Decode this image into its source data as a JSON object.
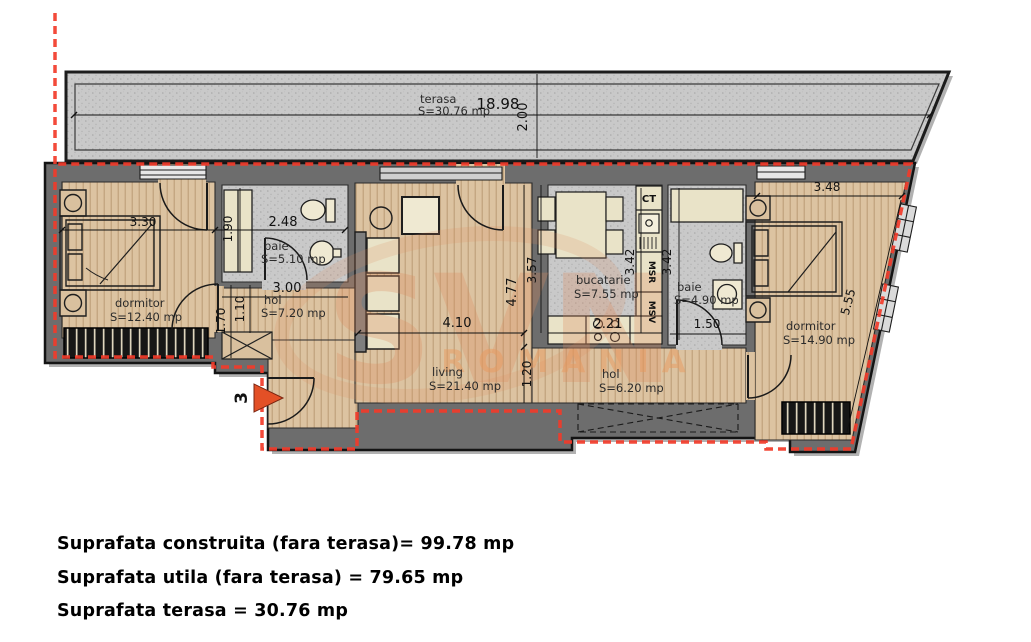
{
  "colors": {
    "boundary_red": "#f23b2a",
    "wall_gray": "#6d6d6d",
    "wood_floor": "#dcc3a1",
    "tile_gray": "#c9c9c9",
    "entrance_arrow_orange": "#e35026",
    "watermark_orange": "#dd8a5c"
  },
  "plan": {
    "terrace": {
      "name": "terasa",
      "area": "S=30.76 mp",
      "length": "18.98",
      "depth": "2.00"
    },
    "rooms": {
      "dormitor1": {
        "name": "dormitor",
        "area": "S=12.40 mp"
      },
      "baie1": {
        "name": "baie",
        "area": "S=5.10 mp"
      },
      "hol1": {
        "name": "hol",
        "area": "S=7.20 mp"
      },
      "living": {
        "name": "living",
        "area": "S=21.40 mp"
      },
      "bucatarie": {
        "name": "bucatarie",
        "area": "S=7.55 mp"
      },
      "baie2": {
        "name": "baie",
        "area": "S=4.90 mp"
      },
      "hol2": {
        "name": "hol",
        "area": "S=6.20 mp"
      },
      "dormitor2": {
        "name": "dormitor",
        "area": "S=14.90 mp"
      }
    },
    "dims": {
      "dorm1_width": "3.30",
      "baie1_width": "2.48",
      "baie1_depth": "1.90",
      "hol1_width": "3.00",
      "hol1_d1": "1.10",
      "hol1_d2": "1.70",
      "living_width": "4.10",
      "living_depth": "4.77",
      "living_d2": "1.20",
      "kitchen_side": "3.57",
      "kitchen_depth": "3.42",
      "kitchen_width": "2.21",
      "baie2_depth": "3.42",
      "baie2_width": "1.50",
      "dorm2_width": "3.48",
      "dorm2_slant": "5.55"
    },
    "appliances": {
      "ct": "CT",
      "msr": "MSR",
      "msv": "MSV"
    },
    "entrance_number": "3",
    "watermark": {
      "logo": "SVN",
      "sub": "ROMANIA"
    }
  },
  "summary": {
    "construita": "Suprafata construita (fara terasa)= 99.78 mp",
    "utila": "Suprafata utila (fara terasa) = 79.65 mp",
    "terasa": "Suprafata terasa = 30.76 mp"
  }
}
